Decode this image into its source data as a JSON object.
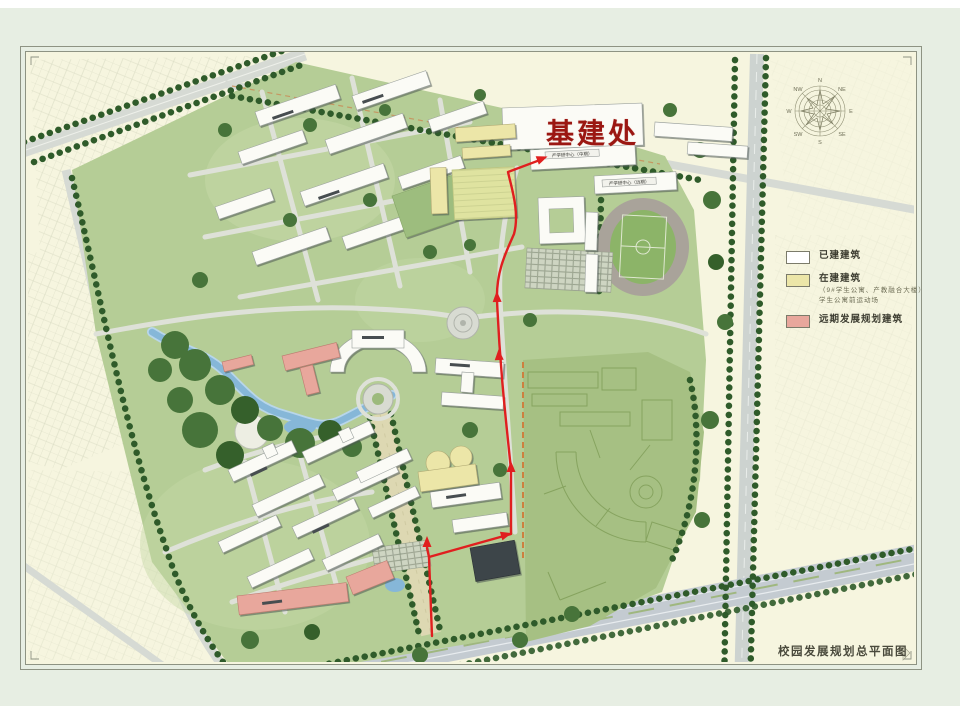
{
  "figure_label": {
    "text": "基建处",
    "color": "#9b1712"
  },
  "legend": {
    "items": [
      {
        "swatch": "#ffffff",
        "label": "已建建筑"
      },
      {
        "swatch": "#ece6a8",
        "label": "在建建筑",
        "notes": [
          "（9#学生公寓、产教融合大楼）",
          "学生公寓前运动场"
        ]
      },
      {
        "swatch": "#e8a79c",
        "label": "远期发展规划建筑"
      }
    ]
  },
  "title": {
    "text": "校园发展规划总平面图"
  },
  "compass": {
    "labels": [
      "N",
      "NE",
      "E",
      "SE",
      "S",
      "SW",
      "W",
      "NW"
    ]
  },
  "buildings": {
    "industry_center_mid": "产学研中心（中期）",
    "industry_center_far": "产学研中心（远期）"
  },
  "route": {
    "color": "#e01f1f"
  },
  "map_colors": {
    "built_building": "#ffffff",
    "under_construction": "#ece6a8",
    "planned_building": "#e8a79c",
    "campus_green": "#b5cd96",
    "future_zone_green": "#a6c083",
    "water": "#86b7d8",
    "paper": "#f6f5df"
  }
}
